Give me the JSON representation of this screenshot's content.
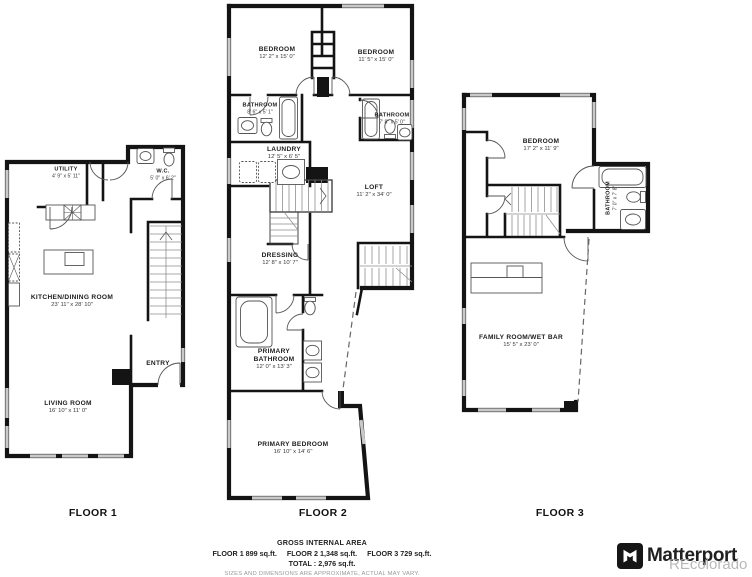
{
  "brand": {
    "name": "Matterport",
    "watermark": "REcolorado"
  },
  "footer": {
    "title": "GROSS INTERNAL AREA",
    "floor1_area": "FLOOR 1 899 sq.ft.",
    "floor2_area": "FLOOR 2 1,348 sq.ft.",
    "floor3_area": "FLOOR 3 729 sq.ft.",
    "total": "TOTAL :  2,976 sq.ft.",
    "disclaimer": "SIZES AND DIMENSIONS ARE APPROXIMATE, ACTUAL MAY VARY."
  },
  "floors": [
    {
      "label": "FLOOR 1",
      "rooms": [
        {
          "name": "UTILITY",
          "dims": "4' 9\" x 5' 11\""
        },
        {
          "name": "W.C.",
          "dims": "5' 0\" x 6' 2\""
        },
        {
          "name": "KITCHEN/DINING ROOM",
          "dims": "23' 11\" x 28' 10\""
        },
        {
          "name": "LIVING ROOM",
          "dims": "16' 10\" x 11' 0\""
        },
        {
          "name": "ENTRY",
          "dims": ""
        }
      ]
    },
    {
      "label": "FLOOR 2",
      "rooms": [
        {
          "name": "BEDROOM",
          "dims": "12' 2\" x 15' 0\""
        },
        {
          "name": "BEDROOM",
          "dims": "11' 5\" x 15' 0\""
        },
        {
          "name": "BATHROOM",
          "dims": "8' 6\" x 5' 1\""
        },
        {
          "name": "BATHROOM",
          "dims": "7' 8\" x 5' 0\""
        },
        {
          "name": "LAUNDRY",
          "dims": "12' 5\" x 6' 5\""
        },
        {
          "name": "LOFT",
          "dims": "11' 2\" x 34' 0\""
        },
        {
          "name": "DRESSING",
          "dims": "12' 8\" x 10' 7\""
        },
        {
          "name": "PRIMARY BATHROOM",
          "dims": "12' 0\" x 13' 3\""
        },
        {
          "name": "PRIMARY BEDROOM",
          "dims": "16' 10\" x 14' 6\""
        }
      ]
    },
    {
      "label": "FLOOR 3",
      "rooms": [
        {
          "name": "BEDROOM",
          "dims": "17' 2\" x 11' 9\""
        },
        {
          "name": "BATHROOM",
          "dims": "7' 0\" x 7' 8\""
        },
        {
          "name": "FAMILY ROOM/WET BAR",
          "dims": "15' 5\" x 23' 0\""
        }
      ]
    }
  ]
}
